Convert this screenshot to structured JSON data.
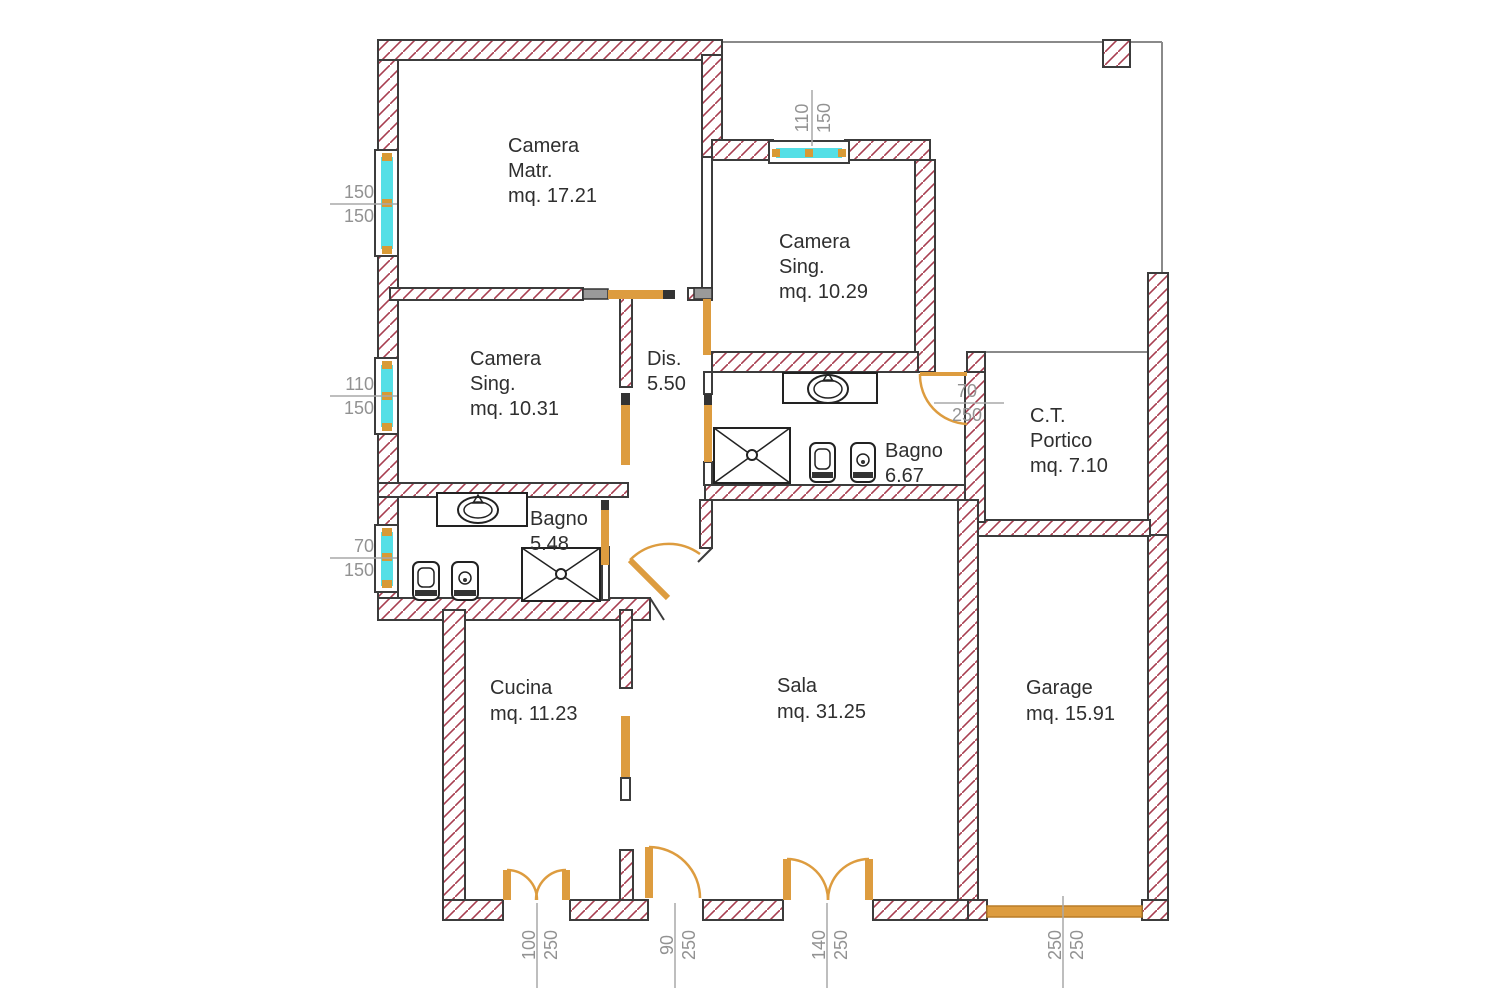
{
  "plan": {
    "rooms": {
      "camera_matr": {
        "line1": "Camera",
        "line2": "Matr.",
        "line3": "mq. 17.21"
      },
      "camera_sing_nord": {
        "line1": "Camera",
        "line2": "Sing.",
        "line3": "mq. 10.29"
      },
      "camera_sing_ovest": {
        "line1": "Camera",
        "line2": "Sing.",
        "line3": "mq. 10.31"
      },
      "disimpegno": {
        "line1": "Dis.",
        "line2": "5.50"
      },
      "bagno_grande": {
        "line1": "Bagno",
        "line2": "6.67"
      },
      "bagno_piccolo": {
        "line1": "Bagno",
        "line2": "5.48"
      },
      "ct_portico": {
        "line1": "C.T.",
        "line2": "Portico",
        "line3": "mq. 7.10"
      },
      "cucina": {
        "line1": "Cucina",
        "line2": "mq. 11.23"
      },
      "sala": {
        "line1": "Sala",
        "line2": "mq. 31.25"
      },
      "garage": {
        "line1": "Garage",
        "line2": "mq. 15.91"
      }
    },
    "dimensions": {
      "window_left_top": {
        "num": "150",
        "den": "150"
      },
      "window_left_mid": {
        "num": "110",
        "den": "150"
      },
      "window_left_bottom": {
        "num": "70",
        "den": "150"
      },
      "window_top": {
        "num": "110",
        "den": "150"
      },
      "door_portico": {
        "num": "70",
        "den": "250"
      },
      "door_cucina": {
        "num": "100",
        "den": "250"
      },
      "door_ingresso": {
        "num": "90",
        "den": "250"
      },
      "door_sala": {
        "num": "140",
        "den": "250"
      },
      "porta_garage": {
        "num": "250",
        "den": "250"
      }
    },
    "colors": {
      "wall_hatch_line": "#a83e50",
      "wall_outline": "#3c3c3c",
      "window_glass": "#54dfe6",
      "window_accent": "#d89a35",
      "door": "#dd9c3f",
      "dim_text": "#929292",
      "room_text": "#2f2f2f"
    }
  }
}
